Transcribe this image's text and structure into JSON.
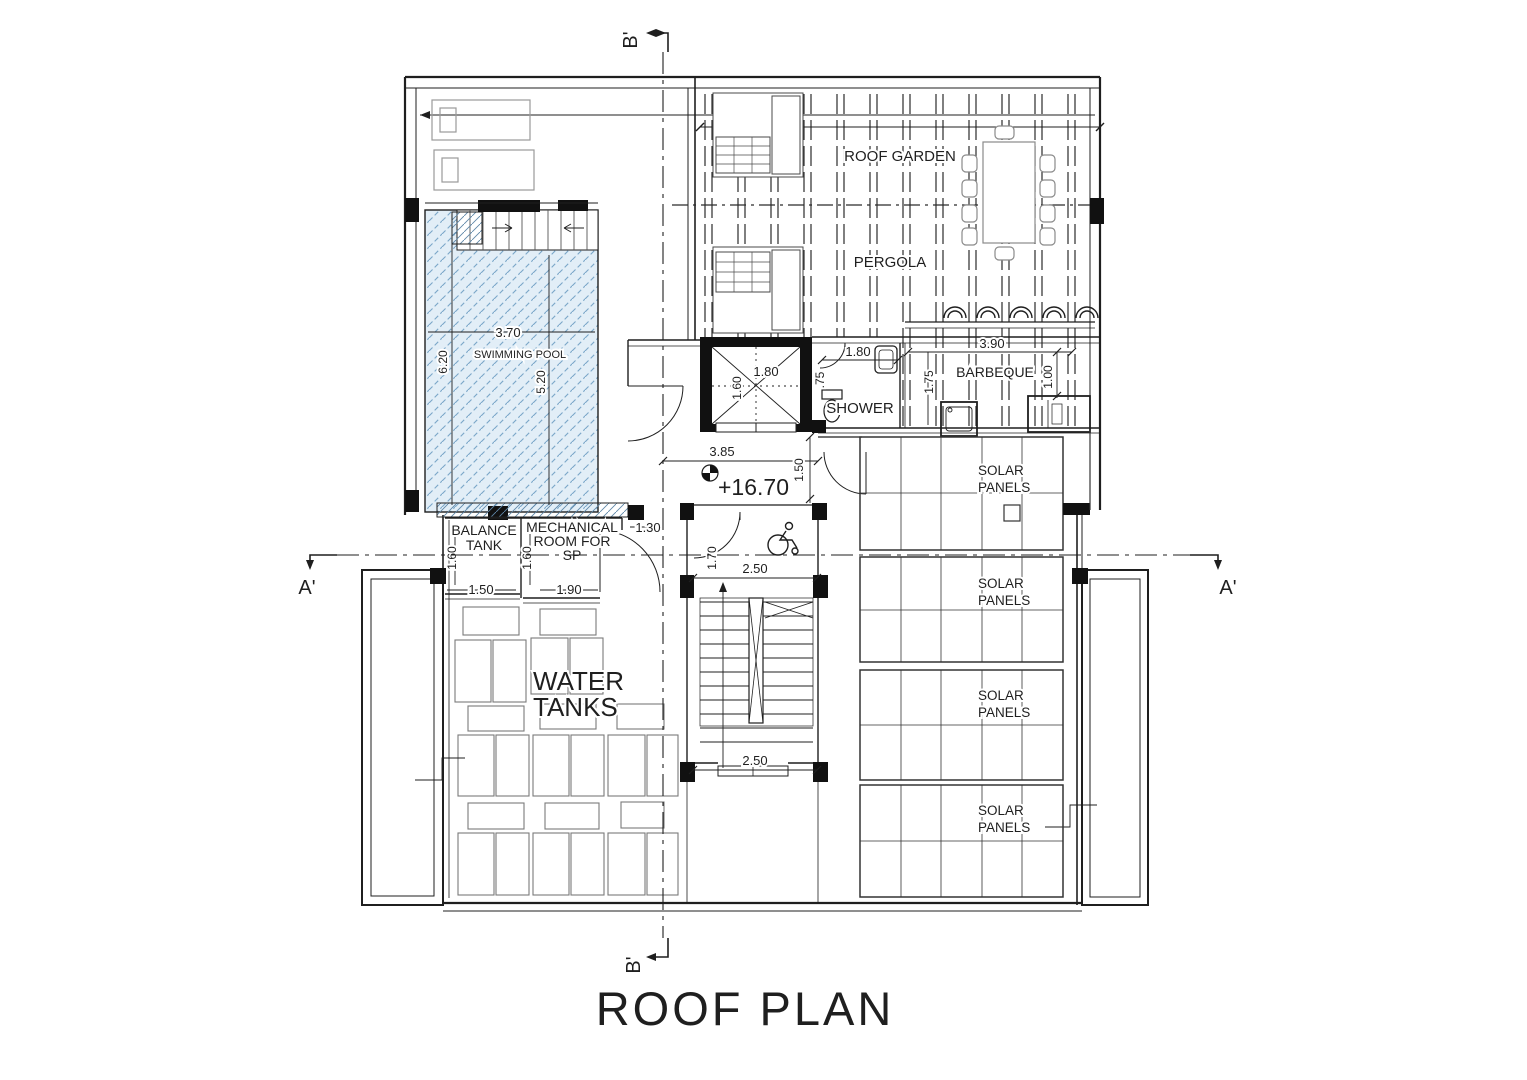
{
  "title": "ROOF PLAN",
  "markers": {
    "b_top": "B'",
    "b_bottom": "B'",
    "a_left": "A'",
    "a_right": "A'"
  },
  "labels": {
    "roof_garden": "ROOF GARDEN",
    "pergola": "PERGOLA",
    "swimming_pool": "SWIMMING POOL",
    "shower": "SHOWER",
    "barbeque": "BARBEQUE",
    "balance_tank": {
      "line1": "BALANCE",
      "line2": "TANK"
    },
    "mechanical_room": {
      "line1": "MECHANICAL",
      "line2": "ROOM FOR",
      "line3": "SP"
    },
    "water_tanks": {
      "line1": "WATER",
      "line2": "TANKS"
    },
    "solar_panels": {
      "line1": "SOLAR",
      "line2": "PANELS"
    },
    "level": "+16.70"
  },
  "dimensions": {
    "roof_width": "13.90",
    "pool_width": "3.70",
    "pool_length": "6.20",
    "pool_inner": "5.20",
    "elevator_width": "1.80",
    "elevator_depth": "1.60",
    "shower_width": "1.80",
    "shower_side": ".75",
    "barbeque_side": "1.75",
    "barbeque_width": "3.90",
    "barbeque_depth": "1.00",
    "corridor_width": "3.85",
    "corridor_depth": "1.50",
    "door_width": "1.30",
    "stair_width_top": "2.50",
    "stair_width_bottom": "2.50",
    "stair_landing": "1.70",
    "balance_depth": "1.60",
    "balance_width": "1.50",
    "mech_depth": "1.60",
    "mech_width": "1.90"
  },
  "colors": {
    "line": "#1f1f1f",
    "pool_fill": "#e2eef7",
    "pool_hatch": "#7ba7c9"
  }
}
